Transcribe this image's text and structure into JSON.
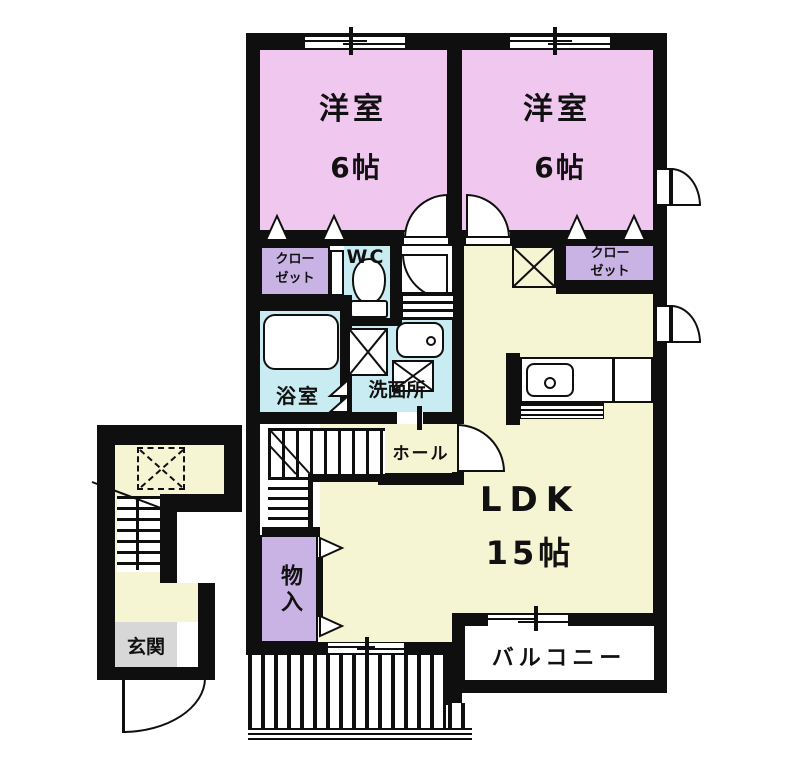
{
  "floorplan": {
    "type": "apartment-floor-plan",
    "colors": {
      "wall": "#0f0f0f",
      "pink": "#f0c7ee",
      "purple": "#c9b3e4",
      "cream": "#f5f4d3",
      "blue": "#c9ecf2",
      "gray": "#d7d7d7"
    },
    "rooms": {
      "bedroom1": {
        "name": "洋室",
        "size": "6帖"
      },
      "bedroom2": {
        "name": "洋室",
        "size": "6帖"
      },
      "closet1": {
        "line1": "クロー",
        "line2": "ゼット"
      },
      "closet2": {
        "line1": "クロー",
        "line2": "ゼット"
      },
      "wc": {
        "name": "WC"
      },
      "bath": {
        "name": "浴室"
      },
      "washroom": {
        "name": "洗面所"
      },
      "hall": {
        "name": "ホール"
      },
      "ldk": {
        "name": "LDK",
        "size": "15帖"
      },
      "storage": {
        "name": "物入"
      },
      "entrance": {
        "name": "玄関"
      },
      "balcony": {
        "name": "バルコニー"
      }
    }
  }
}
